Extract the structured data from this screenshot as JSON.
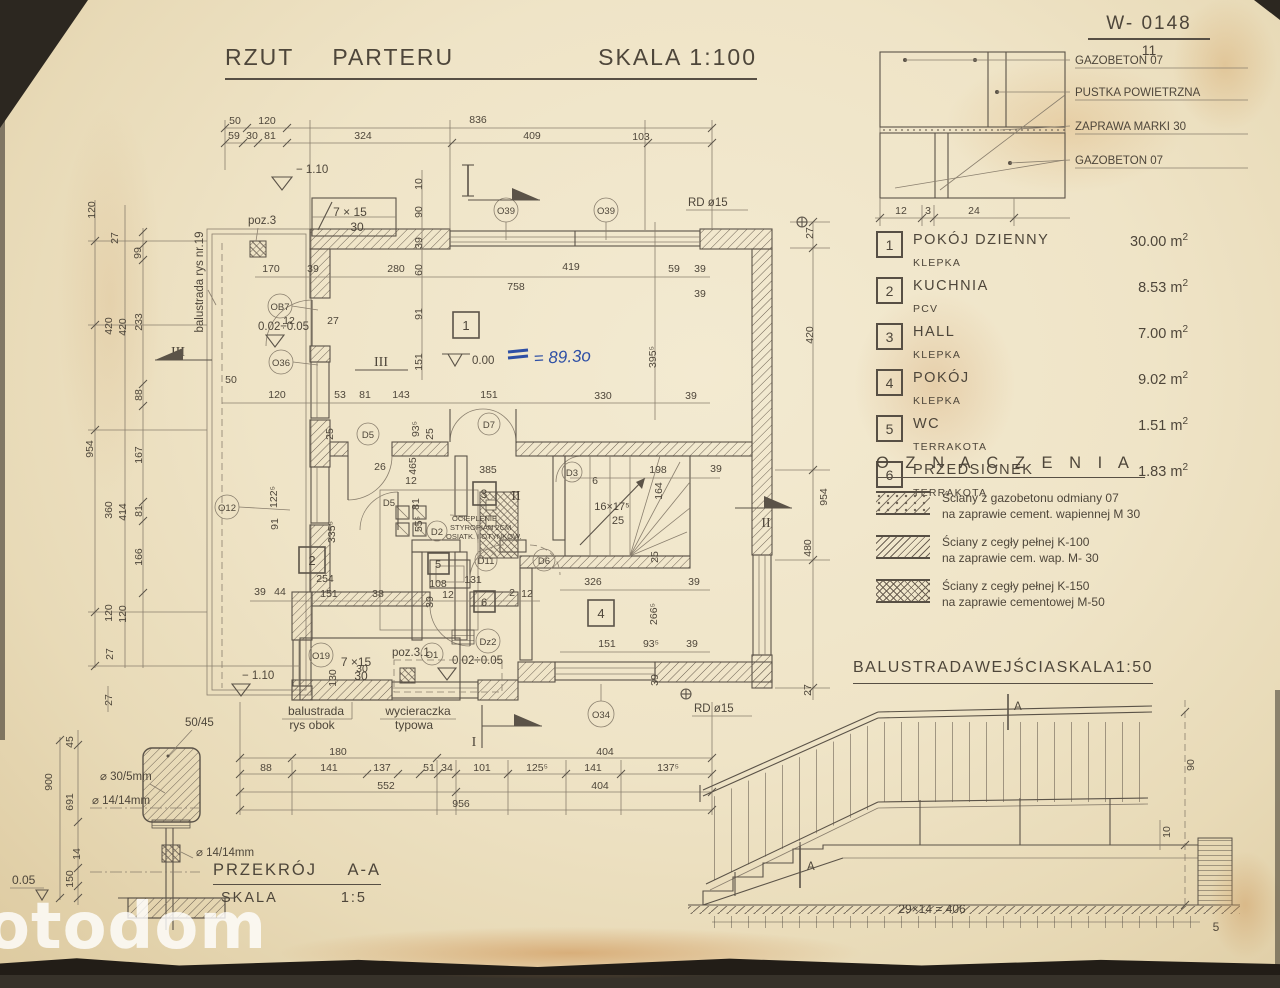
{
  "watermark": "otodom",
  "colors": {
    "paper": "#efe4c7",
    "line": "#574f44",
    "blue_ink": "#2e4fa5"
  },
  "title_block": {
    "word1": "RZUT",
    "word2": "PARTERU",
    "scale": "SKALA 1:100"
  },
  "doc_ref": {
    "code": "W- 0148",
    "sheet": "11"
  },
  "wall_detail": {
    "label1": "GAZOBETON 07",
    "label2": "PUSTKA POWIETRZNA",
    "label3": "ZAPRAWA MARKI 30",
    "label4": "GAZOBETON 07",
    "dim1": "12",
    "dim2": "3",
    "dim3": "24"
  },
  "rooms_table": {
    "rows": [
      {
        "num": "1",
        "name": "POKÓJ  DZIENNY",
        "floor": "KLEPKA",
        "area": "30.00",
        "unit": "m",
        "sup": "2"
      },
      {
        "num": "2",
        "name": "KUCHNIA",
        "floor": "PCV",
        "area": "8.53",
        "unit": "m",
        "sup": "2"
      },
      {
        "num": "3",
        "name": "HALL",
        "floor": "KLEPKA",
        "area": "7.00",
        "unit": "m",
        "sup": "2"
      },
      {
        "num": "4",
        "name": "POKÓJ",
        "floor": "KLEPKA",
        "area": "9.02",
        "unit": "m",
        "sup": "2"
      },
      {
        "num": "5",
        "name": "WC",
        "floor": "TERRAKOTA",
        "area": "1.51",
        "unit": "m",
        "sup": "2"
      },
      {
        "num": "6",
        "name": "PRZEDSIONEK",
        "floor": "TERRAKOTA",
        "area": "1.83",
        "unit": "m",
        "sup": "2"
      }
    ]
  },
  "legend": {
    "title": "O Z N A C Z E N I A",
    "items": [
      {
        "line1": "Ściany z gazobetonu odmiany 07",
        "line2": "na zaprawie cement. wapiennej M 30"
      },
      {
        "line1": "Ściany z cegły pełnej K-100",
        "line2": "na zaprawie cem. wap. M- 30"
      },
      {
        "line1": "Ściany z cegły pełnej K-150",
        "line2": "na zaprawie cementowej M-50"
      }
    ]
  },
  "balustrade": {
    "word1": "BALUSTRADA",
    "word2": "WEJŚCIA",
    "word3": "SKALA",
    "word4": "1:50",
    "marker_top": "A",
    "marker_bottom": "A",
    "dim_height": "90",
    "dim_offset": "10",
    "dim_run": "29×14 = 406",
    "dim_end": "5"
  },
  "section_aa": {
    "title": "PRZEKRÓJ",
    "title_mark": "A-A",
    "scale_label": "SKALA",
    "scale_value": "1:5",
    "handrail_size": "50/45",
    "weld": "30/5mm",
    "rod_a": "14/14mm",
    "rod_b": "14/14mm",
    "level": "0.05",
    "dim_45": "45",
    "dim_900": "900",
    "dim_691": "691",
    "dim_14": "14",
    "dim_150": "150",
    "dim_27": "27"
  },
  "plan": {
    "top_row1": [
      "50",
      "120",
      "836"
    ],
    "top_row2": [
      "59",
      "30",
      "81",
      "324",
      "409",
      "103"
    ],
    "left_col": [
      "120",
      "27",
      "99",
      "420",
      "420",
      "233",
      "88",
      "954",
      "167",
      "360",
      "414",
      "81",
      "166",
      "120",
      "120",
      "27"
    ],
    "right_col": [
      "27",
      "420",
      "954",
      "480",
      "27"
    ],
    "bottom_row1": [
      "180",
      "404"
    ],
    "bottom_row2": [
      "88",
      "141",
      "137",
      "51",
      "34",
      "101",
      "125⁵",
      "141",
      "137⁵"
    ],
    "bottom_row3": [
      "552",
      "404"
    ],
    "bottom_row4": [
      "956"
    ],
    "inner": [
      "10",
      "90",
      "39",
      "60",
      "91",
      "151",
      "170",
      "39",
      "280",
      "758",
      "419",
      "59",
      "39",
      "39",
      "395⁵",
      "330",
      "39",
      "12",
      "27",
      "50",
      "120",
      "53",
      "81",
      "143",
      "151",
      "93⁵",
      "25",
      "25",
      "26",
      "465",
      "12",
      "81",
      "385",
      "122⁵",
      "91",
      "335⁵",
      "55⁵",
      "254",
      "39",
      "44",
      "151",
      "38",
      "108",
      "39",
      "12",
      "131",
      "2",
      "12",
      "130",
      "30",
      "6",
      "198",
      "164",
      "39",
      "25",
      "326",
      "39",
      "266⁵",
      "151",
      "93⁵",
      "39",
      "39"
    ],
    "rooms": [
      "1",
      "2",
      "3",
      "4",
      "5",
      "6"
    ],
    "tags": {
      "o39a": "O39",
      "o39b": "O39",
      "rd15a": "RD ø15",
      "rd15b": "RD ø15",
      "ob7": "OB7",
      "o36": "O36",
      "o12": "O12",
      "o19": "O19",
      "o1": "O1",
      "o34": "O34",
      "dz2": "Dz2",
      "d5a": "D5",
      "d5b": "D5",
      "d7": "D7",
      "d2": "D2",
      "d11": "D11",
      "d6": "D6",
      "d3": "D3"
    },
    "stairs": {
      "top_label": "7 × 15",
      "top_sub": "30",
      "bottom_label": "7 ×15",
      "bottom_sub": "30",
      "winder_label": "16×17⁵",
      "winder_sub": "25"
    },
    "levels": {
      "minus_top": "− 1.10",
      "range_top": "0.02÷0.05",
      "zero": "0.00",
      "handwritten": "= 89.3o",
      "range_bottom": "0.02÷0.05",
      "minus_bottom": "− 1.10"
    },
    "notes": {
      "poz3": "poz.3",
      "poz31": "poz.3.1",
      "balustrada_nr19": "balustrada rys nr.19",
      "balustrada_obok_1": "balustrada",
      "balustrada_obok_2": "rys obok",
      "wycieraczka_1": "wycieraczka",
      "wycieraczka_2": "typowa",
      "ocieplenie_1": "OCIEPLENIE",
      "ocieplenie_2": "STYROPIAN 2CM",
      "ocieplenie_3": "OSIATK. I OTYNKOW."
    },
    "sections": {
      "i_top": "I",
      "iii_left": "III",
      "iii_mid": "III",
      "ii_mid": "II",
      "ii_right": "II",
      "i_bottom": "I"
    }
  }
}
